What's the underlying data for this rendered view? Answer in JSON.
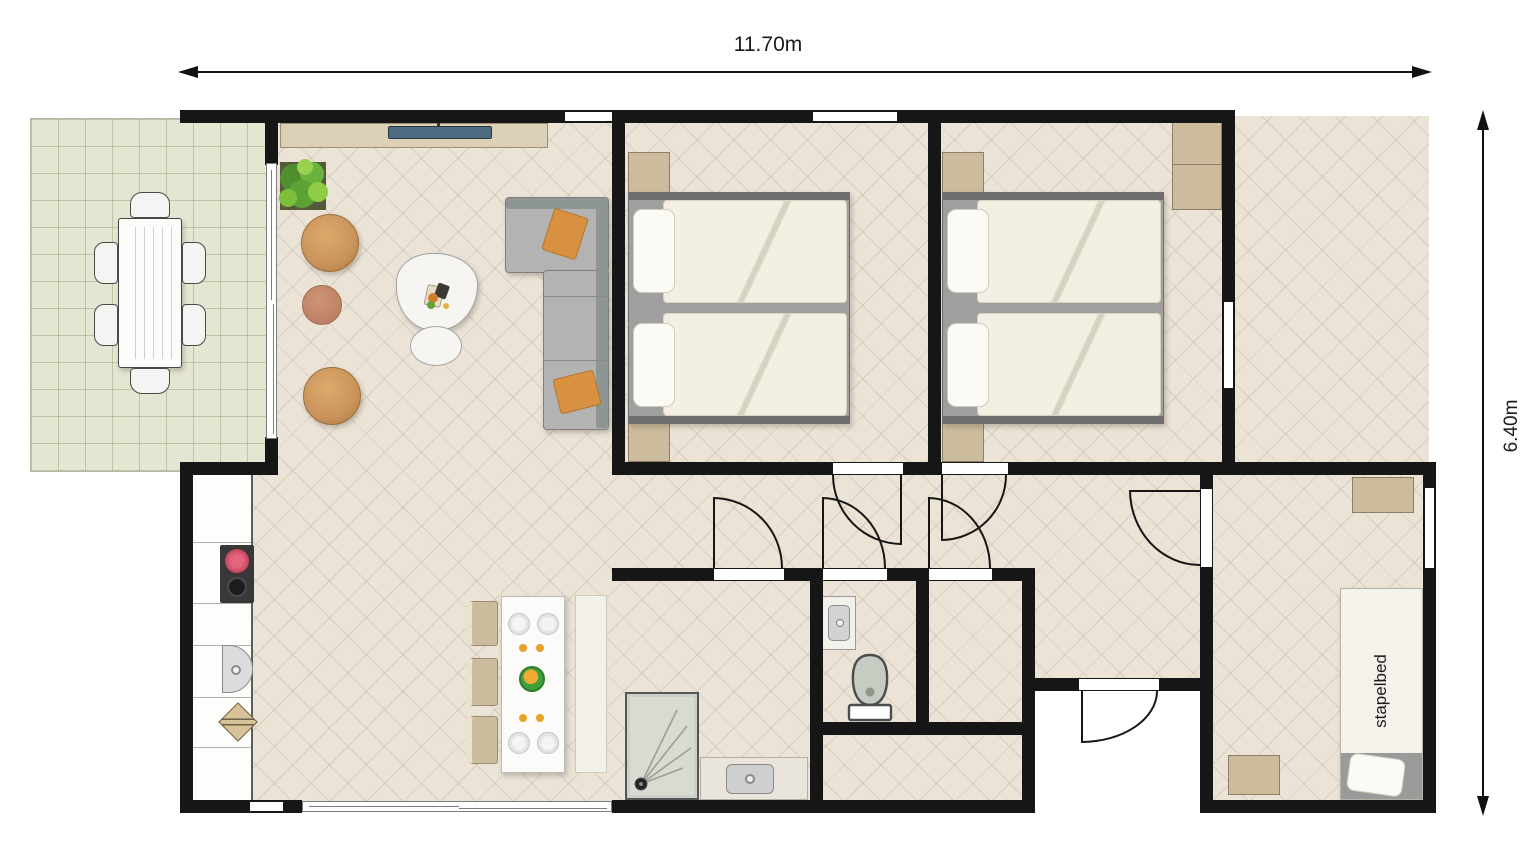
{
  "title": "holiday-home-floor-plan",
  "dimensions": {
    "width_label": "11.70m",
    "height_label": "6.40m"
  },
  "labels": {
    "bunk_bed": "stapelbed"
  },
  "colors": {
    "wall": "#161616",
    "floor": "#eae3d6",
    "floor_line": "#cfc6b4",
    "terrace_tile": "#e4e6d2",
    "cabinet_beige": "#cdbb9d",
    "sofa_gray": "#b3b3b3",
    "cushion_orange": "#d79140",
    "pouf_tan": "#cd9a5c",
    "plant_green": "#6ab33e",
    "tv_navy": "#4e6a80",
    "duvet_cream": "#f3f0e3",
    "shower_sage": "#ccd1c8",
    "bowl_green": "#3f9f3c"
  }
}
